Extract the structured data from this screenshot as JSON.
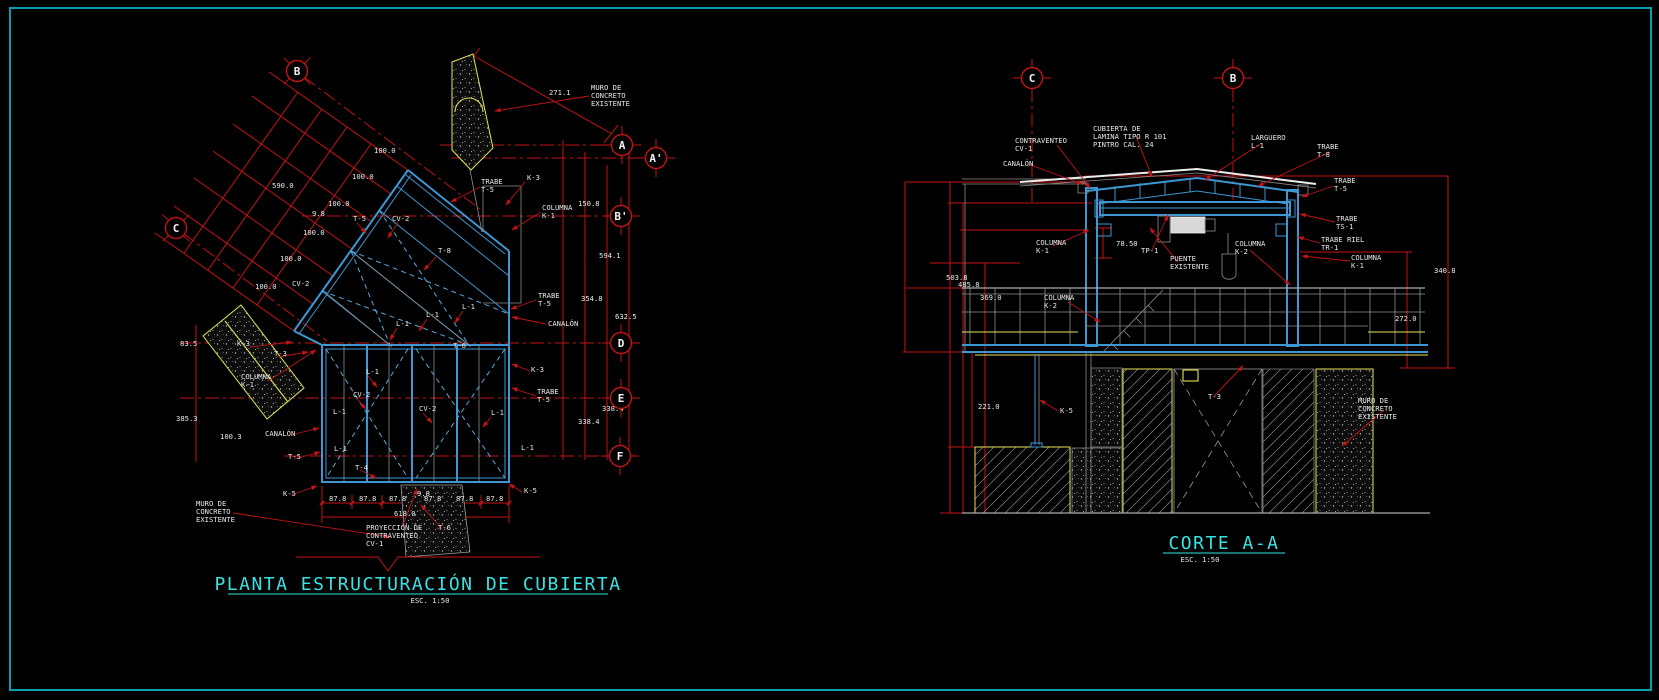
{
  "sheet": {
    "background": "#000000",
    "frame_color": "#0b9fae"
  },
  "colors": {
    "red": "#c51414",
    "blue": "#3e97d3",
    "cyan": "#39e2e2",
    "yellow": "#e3e35c",
    "gray": "#8f8f8f",
    "white": "#e9e9e9"
  },
  "plan": {
    "title": "PLANTA ESTRUCTURACIÓN DE CUBIERTA",
    "scale_label": "ESC. 1:50",
    "grid_bubbles": [
      {
        "letter": "B",
        "x": 297,
        "y": 71,
        "diag": 1
      },
      {
        "letter": "C",
        "x": 176,
        "y": 228,
        "diag": 1
      },
      {
        "letter": "A",
        "x": 622,
        "y": 145
      },
      {
        "letter": "A'",
        "x": 656,
        "y": 158
      },
      {
        "letter": "B'",
        "x": 621,
        "y": 216
      },
      {
        "letter": "D",
        "x": 621,
        "y": 343
      },
      {
        "letter": "E",
        "x": 621,
        "y": 398
      },
      {
        "letter": "F",
        "x": 620,
        "y": 456
      }
    ],
    "labels": [
      {
        "t": "271.1",
        "x": 549,
        "y": 95
      },
      {
        "lines": [
          "MURO DE",
          "CONCRETO",
          "EXISTENTE"
        ],
        "x": 591,
        "y": 90
      },
      {
        "lines": [
          "TRABE",
          "T-5"
        ],
        "x": 481,
        "y": 184
      },
      {
        "t": "K-3",
        "x": 527,
        "y": 180
      },
      {
        "lines": [
          "COLUMNA",
          "K-1"
        ],
        "x": 542,
        "y": 210
      },
      {
        "t": "150.8",
        "x": 578,
        "y": 206
      },
      {
        "t": "100.0",
        "x": 374,
        "y": 153
      },
      {
        "t": "100.0",
        "x": 352,
        "y": 179
      },
      {
        "t": "590.0",
        "x": 272,
        "y": 188
      },
      {
        "t": "100.0",
        "x": 328,
        "y": 206
      },
      {
        "t": "9.8",
        "x": 312,
        "y": 216
      },
      {
        "t": "T-5",
        "x": 353,
        "y": 221
      },
      {
        "t": "CV-2",
        "x": 392,
        "y": 221
      },
      {
        "t": "100.0",
        "x": 303,
        "y": 235
      },
      {
        "t": "T-8",
        "x": 438,
        "y": 253
      },
      {
        "t": "100.0",
        "x": 280,
        "y": 261
      },
      {
        "t": "594.1",
        "x": 599,
        "y": 258
      },
      {
        "t": "100.0",
        "x": 255,
        "y": 289
      },
      {
        "t": "CV-2",
        "x": 292,
        "y": 286
      },
      {
        "lines": [
          "TRABE",
          "T-5"
        ],
        "x": 538,
        "y": 298
      },
      {
        "t": "354.8",
        "x": 581,
        "y": 301
      },
      {
        "t": "L-1",
        "x": 462,
        "y": 309
      },
      {
        "t": "L-1",
        "x": 426,
        "y": 317
      },
      {
        "t": "L-1",
        "x": 396,
        "y": 326
      },
      {
        "t": "CANALÓN",
        "x": 548,
        "y": 326
      },
      {
        "t": "632.5",
        "x": 615,
        "y": 319
      },
      {
        "t": "83.5",
        "x": 180,
        "y": 346
      },
      {
        "t": "K-3",
        "x": 237,
        "y": 346
      },
      {
        "t": "T-6",
        "x": 453,
        "y": 348
      },
      {
        "t": "T-3",
        "x": 274,
        "y": 356
      },
      {
        "t": "K-3",
        "x": 531,
        "y": 372
      },
      {
        "lines": [
          "COLUMNA",
          "K-1"
        ],
        "x": 241,
        "y": 379
      },
      {
        "t": "L-1",
        "x": 366,
        "y": 374
      },
      {
        "lines": [
          "TRABE",
          "T-5"
        ],
        "x": 537,
        "y": 394
      },
      {
        "t": "CV-2",
        "x": 353,
        "y": 397
      },
      {
        "t": "338.4",
        "x": 602,
        "y": 411
      },
      {
        "t": "CV-2",
        "x": 419,
        "y": 411
      },
      {
        "t": "L-1",
        "x": 333,
        "y": 414
      },
      {
        "t": "L-1",
        "x": 491,
        "y": 415
      },
      {
        "t": "385.3",
        "x": 176,
        "y": 421
      },
      {
        "t": "338.4",
        "x": 578,
        "y": 424
      },
      {
        "t": "CANALÓN",
        "x": 265,
        "y": 436
      },
      {
        "t": "100.3",
        "x": 220,
        "y": 439
      },
      {
        "t": "L-1",
        "x": 334,
        "y": 451
      },
      {
        "t": "L-1",
        "x": 521,
        "y": 450
      },
      {
        "t": "T-5",
        "x": 288,
        "y": 459
      },
      {
        "t": "T-4",
        "x": 355,
        "y": 470
      },
      {
        "t": "K-5",
        "x": 283,
        "y": 496
      },
      {
        "t": "K-5",
        "x": 524,
        "y": 493
      },
      {
        "t": "87.8",
        "x": 329,
        "y": 501
      },
      {
        "t": "87.8",
        "x": 359,
        "y": 501
      },
      {
        "t": "87.8",
        "x": 389,
        "y": 501
      },
      {
        "t": "9.8",
        "x": 417,
        "y": 496
      },
      {
        "t": "87.8",
        "x": 424,
        "y": 501
      },
      {
        "t": "87.8",
        "x": 456,
        "y": 501
      },
      {
        "t": "87.8",
        "x": 486,
        "y": 501
      },
      {
        "t": "618.0",
        "x": 394,
        "y": 516
      },
      {
        "lines": [
          "MURO DE",
          "CONCRETO",
          "EXISTENTE"
        ],
        "x": 196,
        "y": 506
      },
      {
        "lines": [
          "PROYECCIÓN DE",
          "CONTRAVENTEO",
          "CV-1"
        ],
        "x": 366,
        "y": 530
      },
      {
        "t": "T-6",
        "x": 438,
        "y": 530
      }
    ]
  },
  "section": {
    "title": "CORTE A-A",
    "scale_label": "ESC. 1:50",
    "grid_bubbles": [
      {
        "letter": "C",
        "x": 1032,
        "y": 78
      },
      {
        "letter": "B",
        "x": 1233,
        "y": 78
      }
    ],
    "labels": [
      {
        "t": "CANALÓN",
        "x": 1003,
        "y": 166
      },
      {
        "lines": [
          "CONTRAVENTEO",
          "CV-1"
        ],
        "x": 1015,
        "y": 143
      },
      {
        "lines": [
          "CUBIERTA DE",
          "LAMINA TIPO R 101",
          "PINTRO CAL. 24"
        ],
        "x": 1093,
        "y": 131
      },
      {
        "lines": [
          "LARGUERO",
          "L-1"
        ],
        "x": 1251,
        "y": 140
      },
      {
        "lines": [
          "TRABE",
          "T-8"
        ],
        "x": 1317,
        "y": 149
      },
      {
        "lines": [
          "TRABE",
          "T-5"
        ],
        "x": 1334,
        "y": 183
      },
      {
        "lines": [
          "TRABE",
          "TS-1"
        ],
        "x": 1336,
        "y": 221
      },
      {
        "lines": [
          "TRABE RIEL",
          "TR-1"
        ],
        "x": 1321,
        "y": 242
      },
      {
        "lines": [
          "COLUMNA",
          "K-1"
        ],
        "x": 1351,
        "y": 260
      },
      {
        "lines": [
          "COLUMNA",
          "K-1"
        ],
        "x": 1036,
        "y": 245
      },
      {
        "t": "78.50",
        "x": 1116,
        "y": 246
      },
      {
        "t": "TP-1",
        "x": 1141,
        "y": 253
      },
      {
        "lines": [
          "PUENTE",
          "EXISTENTE"
        ],
        "x": 1170,
        "y": 261
      },
      {
        "lines": [
          "COLUMNA",
          "K-2"
        ],
        "x": 1235,
        "y": 246
      },
      {
        "lines": [
          "COLUMNA",
          "K-2"
        ],
        "x": 1044,
        "y": 300
      },
      {
        "t": "503.8",
        "x": 946,
        "y": 280
      },
      {
        "t": "485.8",
        "x": 958,
        "y": 287
      },
      {
        "t": "369.0",
        "x": 980,
        "y": 300
      },
      {
        "t": "340.8",
        "x": 1434,
        "y": 273
      },
      {
        "t": "272.0",
        "x": 1395,
        "y": 321
      },
      {
        "t": "221.0",
        "x": 978,
        "y": 409
      },
      {
        "t": "K-5",
        "x": 1060,
        "y": 413
      },
      {
        "t": "T-3",
        "x": 1208,
        "y": 399
      },
      {
        "lines": [
          "MURO DE",
          "CONCRETO",
          "EXISTENTE"
        ],
        "x": 1358,
        "y": 403
      }
    ]
  }
}
